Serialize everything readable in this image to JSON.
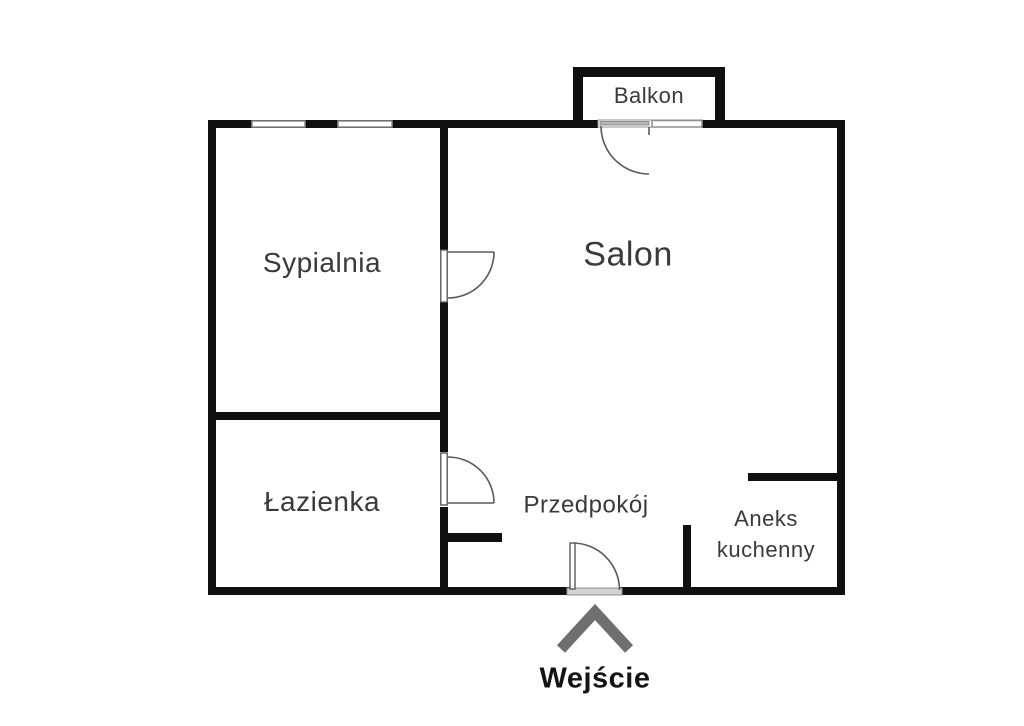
{
  "floorplan": {
    "type": "apartment-floor-plan",
    "colors": {
      "background": "#ffffff",
      "wall": "#101010",
      "label_text": "#3a3a3a",
      "door_line": "#5a5a5a",
      "window_fill": "#ffffff",
      "window_stroke": "#8f8f8f",
      "threshold": "#d2d2d2",
      "arrow": "#6f6f6f",
      "entrance_text": "#141414"
    },
    "rooms": {
      "sypialnia": {
        "label": "Sypialnia"
      },
      "salon": {
        "label": "Salon"
      },
      "lazienka": {
        "label": "Łazienka"
      },
      "przedpokoj": {
        "label": "Przedpokój"
      },
      "aneks_kuchenny": {
        "label": "Aneks kuchenny",
        "lines": [
          "Aneks",
          "kuchenny"
        ]
      },
      "balkon": {
        "label": "Balkon"
      }
    },
    "entrance": {
      "label": "Wejście",
      "arrow_direction": "up"
    }
  }
}
